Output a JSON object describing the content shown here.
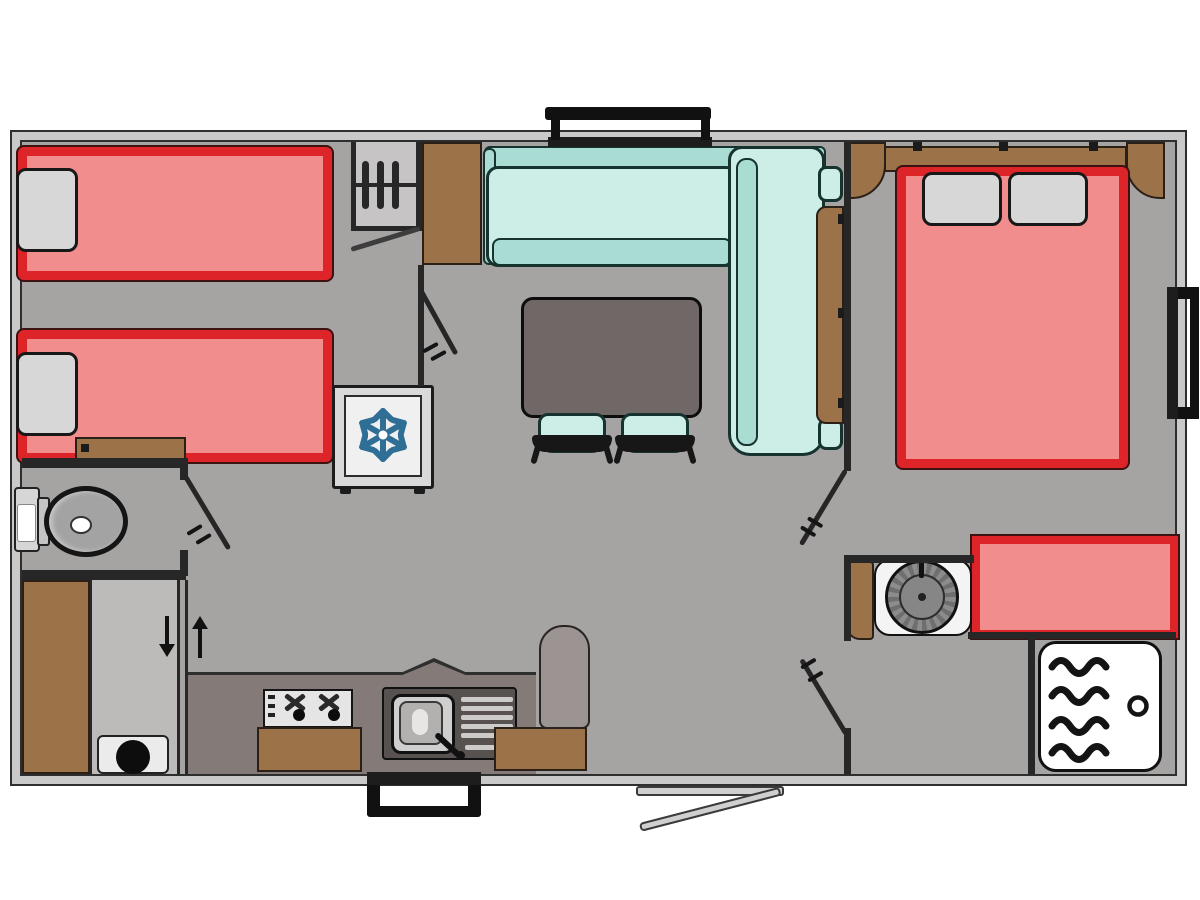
{
  "meta": {
    "type": "floor-plan",
    "subject": "mobile-home-2-bedroom-caravan-layout",
    "canvas": {
      "width": 1200,
      "height": 900
    },
    "has_text": false
  },
  "colors": {
    "background": "#ffffff",
    "wall_fill": "#c9c9c9",
    "wall_line": "#2e2e2e",
    "floor": "#a6a3a3",
    "floor_light": "#bdbaba",
    "closet_floor": "#c6c4c4",
    "partition": "#272727",
    "bed_fill": "#f28d8d",
    "bed_border": "#dd2429",
    "pillow": "#d7d7d7",
    "wood": "#9c7248",
    "wood_dark": "#2a2018",
    "sofa_light": "#cdeee7",
    "sofa_mid": "#a9dcd3",
    "sofa_dark": "#16332f",
    "table": "#6f6866",
    "chair_black": "#171717",
    "counter": "#847a77",
    "counter_edge": "#2f2f2f",
    "sink_unit": "#575250",
    "sink_basin": "#cfcfcf",
    "hob_panel": "#e5e5e5",
    "fridge_panel": "#f0f0f0",
    "snowflake": "#2f6e95",
    "appliance_white": "#ebebeb",
    "shower_white": "#ffffff",
    "ink": "#1b1b1b",
    "basin_ring_a": "#8c8c8c",
    "basin_ring_b": "#6f6f6f",
    "basin_inner": "#868686",
    "toilet_gray": "#a3a3a3",
    "threshold": "#cfcfcf"
  },
  "layout": {
    "rooms": [
      {
        "name": "children-bedroom-twin",
        "position": "top-left",
        "furniture": [
          "single-bed",
          "single-bed",
          "pillow",
          "pillow",
          "open-wardrobe-with-3-hangers",
          "overhead-cabinet",
          "foot-shelf"
        ]
      },
      {
        "name": "wc-room",
        "position": "mid-left",
        "furniture": [
          "toilet-with-cistern"
        ]
      },
      {
        "name": "hall-storage",
        "position": "bottom-left",
        "furniture": [
          "tall-wardrobe",
          "utility-panel",
          "appliance-with-round-dial",
          "down-arrow",
          "up-arrow"
        ]
      },
      {
        "name": "kitchen",
        "position": "bottom-center",
        "furniture": [
          "worktop-with-peak",
          "hob-two-knobs",
          "sink-with-drainer-and-faucet",
          "fridge-with-snowflake",
          "base-cabinet-left",
          "base-cabinet-right",
          "peninsula-counter"
        ]
      },
      {
        "name": "living-dining",
        "position": "center",
        "furniture": [
          "l-shaped-sofa",
          "sofa-side-panel",
          "dining-table",
          "stool",
          "stool"
        ]
      },
      {
        "name": "master-bedroom",
        "position": "top-right",
        "furniture": [
          "double-bed",
          "pillow",
          "pillow",
          "headboard-cabinet",
          "corner-cabinet-left",
          "corner-cabinet-right",
          "bench-seat"
        ]
      },
      {
        "name": "shower-room",
        "position": "bottom-right",
        "furniture": [
          "washbasin-round",
          "vanity-cabinet",
          "shower-tray-with-waves-and-drain"
        ]
      }
    ],
    "doors": [
      {
        "name": "twin-bedroom-door",
        "swing": "into-living"
      },
      {
        "name": "wc-door",
        "swing": "into-hall"
      },
      {
        "name": "master-bedroom-door",
        "swing": "into-living"
      },
      {
        "name": "shower-room-door",
        "swing": "into-living"
      },
      {
        "name": "entrance-door",
        "swing": "outward-bottom"
      },
      {
        "name": "wardrobe-flap",
        "swing": "ajar"
      }
    ],
    "windows": [
      "top-window-above-sofa",
      "right-window-master-bedroom",
      "bottom-window-kitchen"
    ],
    "counts": {
      "single_beds": 2,
      "double_beds": 1,
      "stools": 2,
      "sofas": 1,
      "tables": 1
    }
  }
}
